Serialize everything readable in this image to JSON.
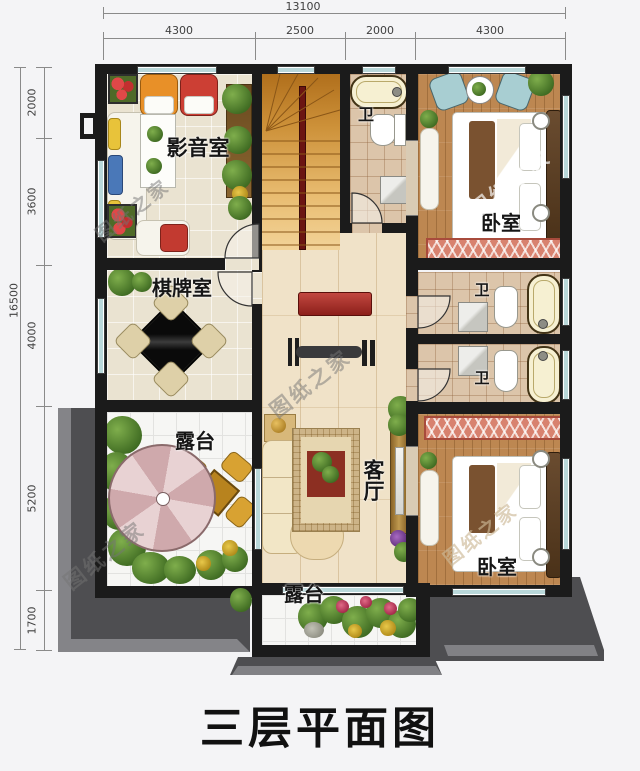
{
  "title": "三层平面图",
  "watermark": {
    "text": "图纸之家"
  },
  "dimensions": {
    "top": {
      "total": "13100",
      "segments": [
        "4300",
        "2500",
        "2000",
        "4300"
      ]
    },
    "left": {
      "total": "16500",
      "segments": [
        "2000",
        "3600",
        "4000",
        "5200",
        "1700"
      ]
    }
  },
  "rooms": {
    "media_room": "影音室",
    "chess_room": "棋牌室",
    "bath_top": "卫",
    "bath_mid1": "卫",
    "bath_mid2": "卫",
    "bedroom_top": "卧室",
    "bedroom_bottom": "卧室",
    "living_room": "客厅",
    "terrace_left": "露台",
    "terrace_bottom": "露台"
  }
}
